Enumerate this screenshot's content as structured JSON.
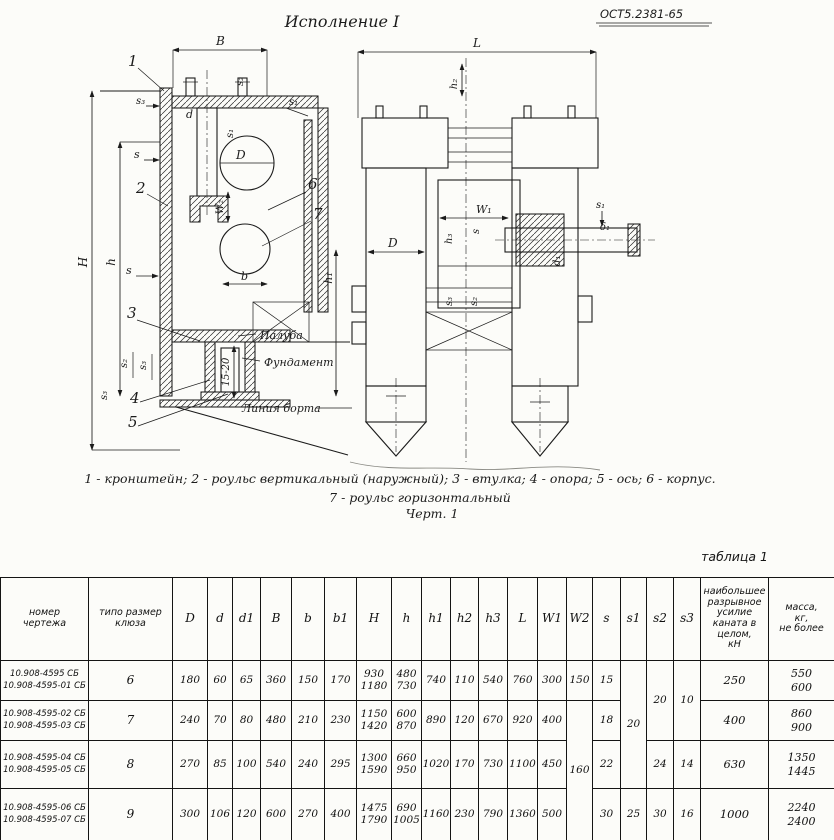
{
  "drawing": {
    "title": "Исполнение I",
    "standard": "ОСТ5.2381-65",
    "caption_line1": "1 - кронштейн;  2 - роульс вертикальный (наружный);  3 - втулка;  4 - опора;  5 - ось;  6 - корпус.",
    "caption_line2": "7 - роульс горизонтальный",
    "caption_line3": "Черт. 1",
    "annotations": {
      "paluba": "Палуба",
      "fundament": "Фундамент",
      "liniya_borta": "Линия борта",
      "gap": "15-20"
    },
    "callouts": [
      "1",
      "2",
      "3",
      "4",
      "5",
      "6",
      "7"
    ],
    "dims": {
      "B": "B",
      "L": "L",
      "H": "H",
      "h": "h",
      "h1": "h₁",
      "h2": "h₂",
      "h3": "h₃",
      "W1": "W₁",
      "W2": "W₂",
      "D": "D",
      "d": "d",
      "d1": "d₁",
      "b": "b",
      "s": "s",
      "s1": "s₁",
      "s2": "s₂",
      "s3": "s₃",
      "delta1": "δ₁"
    }
  },
  "table": {
    "caption": "таблица 1",
    "headers": {
      "nomer": "номер\nчертежа",
      "tiporazmer": "типо размер\nклюза",
      "dims": [
        "D",
        "d",
        "d1",
        "B",
        "b",
        "b1",
        "H",
        "h",
        "h1",
        "h2",
        "h3",
        "L",
        "W1",
        "W2",
        "s",
        "s1",
        "s2",
        "s3"
      ],
      "force": "наибольшее\nразрывное усилие\nканата в целом,\nкН",
      "mass": "масса,\nкг,\nне более"
    },
    "rows": [
      {
        "nomer": "10.908-4595 СБ\n10.908-4595-01 СБ",
        "size": "6",
        "D": "180",
        "d": "60",
        "d1": "65",
        "B": "360",
        "b": "150",
        "b1": "170",
        "H": "930\n1180",
        "h": "480\n730",
        "h1": "740",
        "h2": "110",
        "h3": "540",
        "L": "760",
        "W1": "300",
        "W2": "150",
        "s": "15",
        "force": "250",
        "mass": "550\n600"
      },
      {
        "nomer": "10.908-4595-02 СБ\n10.908-4595-03 СБ",
        "size": "7",
        "D": "240",
        "d": "70",
        "d1": "80",
        "B": "480",
        "b": "210",
        "b1": "230",
        "H": "1150\n1420",
        "h": "600\n870",
        "h1": "890",
        "h2": "120",
        "h3": "670",
        "L": "920",
        "W1": "400",
        "s": "18",
        "force": "400",
        "mass": "860\n900"
      },
      {
        "nomer": "10.908-4595-04 СБ\n10.908-4595-05 СБ",
        "size": "8",
        "D": "270",
        "d": "85",
        "d1": "100",
        "B": "540",
        "b": "240",
        "b1": "295",
        "H": "1300\n1590",
        "h": "660\n950",
        "h1": "1020",
        "h2": "170",
        "h3": "730",
        "L": "1100",
        "W1": "450",
        "s": "22",
        "s2": "24",
        "s3": "14",
        "force": "630",
        "mass": "1350\n1445"
      },
      {
        "nomer": "10.908-4595-06 СБ\n10.908-4595-07 СБ",
        "size": "9",
        "D": "300",
        "d": "106",
        "d1": "120",
        "B": "600",
        "b": "270",
        "b1": "400",
        "H": "1475\n1790",
        "h": "690\n1005",
        "h1": "1160",
        "h2": "230",
        "h3": "790",
        "L": "1360",
        "W1": "500",
        "s": "30",
        "s1": "25",
        "s2": "30",
        "s3": "16",
        "force": "1000",
        "mass": "2240\n2400"
      }
    ],
    "merged": {
      "W2_rows234": "160",
      "s1_rows123": "20",
      "s2_rows12": "20",
      "s3_rows12": "10"
    }
  }
}
